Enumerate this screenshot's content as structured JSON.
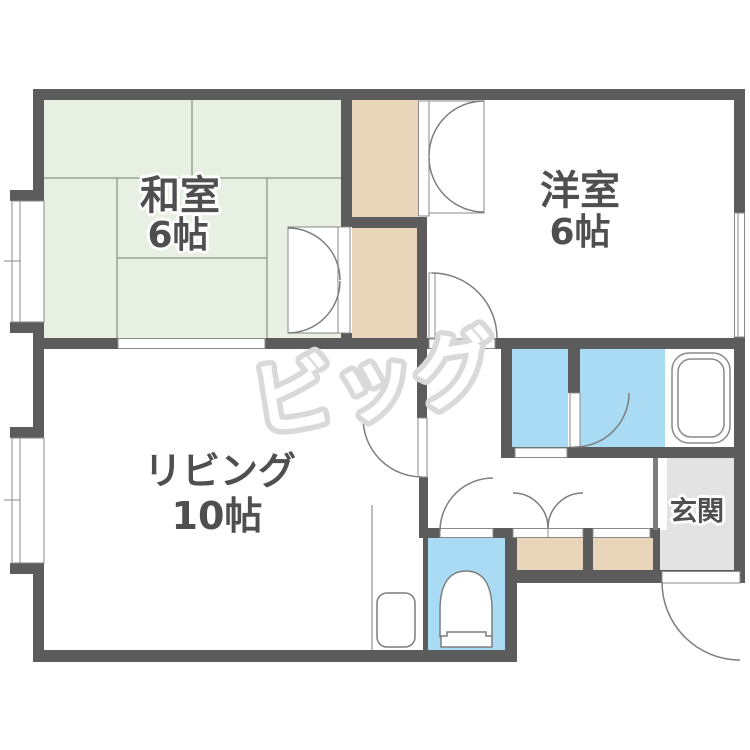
{
  "floorplan": {
    "watermark": "ビッグ",
    "rooms": {
      "washitsu": {
        "label": "和室",
        "size": "6帖"
      },
      "youshitsu": {
        "label": "洋室",
        "size": "6帖"
      },
      "living": {
        "label": "リビング",
        "size": "10帖"
      },
      "genkan": {
        "label": "玄関"
      }
    },
    "fixtures": {
      "bathtub": "bathtub-icon",
      "toilet": "toilet-icon",
      "sink": "sink-icon"
    },
    "colors": {
      "wall": "#5c5c5c",
      "tatami": "#e8efe3",
      "tatami_line": "#96a391",
      "closet": "#e8d5ba",
      "wet_area": "#a9dcf4",
      "entrance_floor": "#e3e3e3",
      "outline": "#7d7d7d",
      "watermark": "#d9d9d9",
      "label_text": "#4f4f4f"
    }
  }
}
